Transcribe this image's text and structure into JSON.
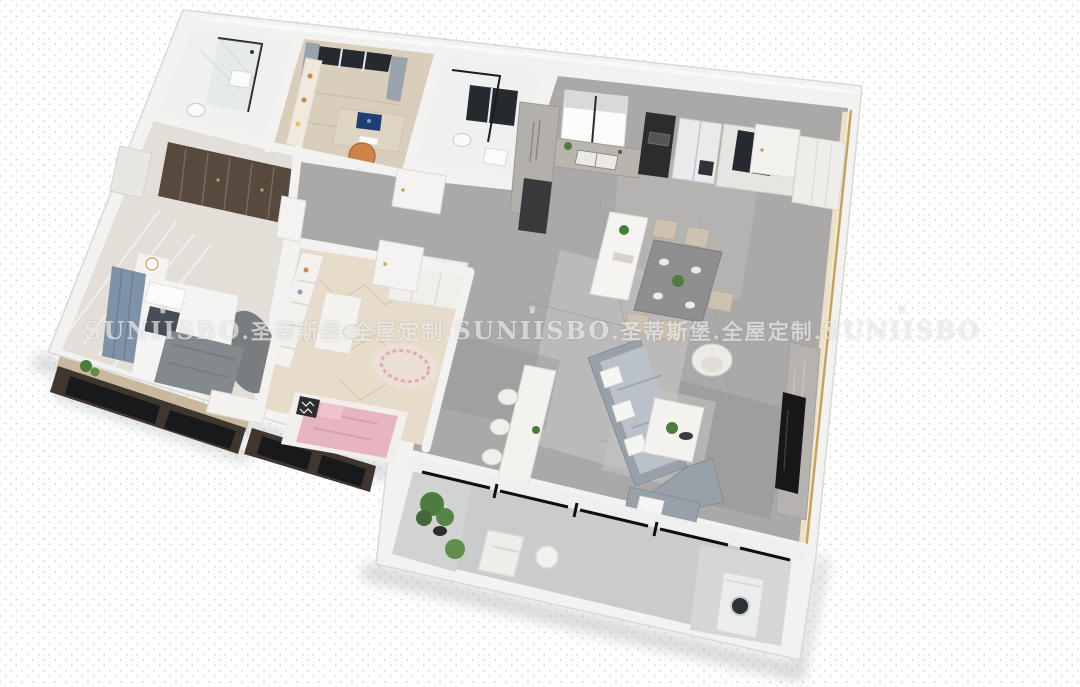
{
  "meta": {
    "type": "3d-apartment-floorplan-render",
    "brand": "SUNIISBO",
    "brand_cn": "圣蒂斯堡",
    "tagline_cn": "全屋定制"
  },
  "watermark": {
    "segments": [
      "SUNIISBO",
      ".圣蒂斯堡.全屋定制.",
      "SUNIISBO",
      ".圣蒂斯堡.全屋定制.",
      "SUNIISBO"
    ],
    "crown_glyph": "♛"
  },
  "palette": {
    "bg": "#ffffff",
    "dot": "#e6e2de",
    "wall": "#f2f2f0",
    "wall_edge": "#d8d8d6",
    "marble": "#aba9a8",
    "marble_light": "#c9c7c6",
    "marble_dark": "#92908f",
    "wood": "#d9cdbb",
    "herring": "#e7dbc9",
    "concrete": "#c9cccb",
    "gold": "#c6a35c",
    "glow": "#f6ead0",
    "sofa": "#98a1aa",
    "sofa_light": "#bac1c8",
    "white_furn": "#f3f2ef",
    "beige": "#cdc2b1",
    "pink": "#e7b4c1",
    "headboard": "#7e92a8",
    "darkwood": "#57493d",
    "orange": "#cc8448",
    "green": "#4e7c3f",
    "dark_glass": "#26292d",
    "fridge": "#e9eaec",
    "tv": "#17171a",
    "shadow": "#aab0b3",
    "bath": "#eff1f1",
    "blanket": "#84898d",
    "watermark": "rgba(252,250,247,0.62)"
  },
  "scene": {
    "view": "isometric-top-down-cutaway",
    "rooms": [
      {
        "name": "living-room",
        "floor": "gray-marble",
        "items": [
          "l-shaped-sofa",
          "loveseat",
          "coffee-table",
          "armchair",
          "console-table-with-chairs",
          "tv-wall",
          "tv"
        ]
      },
      {
        "name": "dining-area",
        "floor": "gray-marble",
        "items": [
          "dining-table",
          "dining-chairs",
          "kitchen-island",
          "plant"
        ]
      },
      {
        "name": "kitchen",
        "floor": "gray-marble",
        "items": [
          "window-with-shade",
          "double-sink",
          "counter",
          "oven-tower",
          "fridge",
          "glass-cabinet",
          "pantry-cabinets"
        ]
      },
      {
        "name": "entry-hall",
        "floor": "gray-marble",
        "items": [
          "shoe-cabinet",
          "entry-door",
          "wardrobe"
        ]
      },
      {
        "name": "hallway",
        "floor": "gray-marble",
        "items": [
          "door",
          "door",
          "door"
        ]
      },
      {
        "name": "master-bedroom",
        "floor": "light-wood-planks",
        "items": [
          "tufted-headboard-bed",
          "gray-blanket",
          "bench",
          "nightstand",
          "lamp",
          "dark-glass-wardrobe",
          "shelf",
          "arch-rug",
          "bay-window"
        ]
      },
      {
        "name": "kids-bedroom",
        "floor": "herringbone-wood",
        "items": [
          "bed-pink-blanket",
          "zigzag-pillow",
          "bookshelf",
          "desk",
          "round-rug",
          "wardrobe",
          "bay-window"
        ]
      },
      {
        "name": "study",
        "floor": "wood",
        "items": [
          "desk",
          "monitor",
          "orange-chair",
          "bookshelf",
          "window",
          "curtains"
        ]
      },
      {
        "name": "bathroom",
        "floor": "white-marble",
        "items": [
          "glass-shower",
          "toilet",
          "vanity"
        ]
      },
      {
        "name": "shower-room",
        "floor": "white-marble",
        "items": [
          "glass-shower",
          "window",
          "toilet"
        ]
      },
      {
        "name": "balcony",
        "floor": "concrete",
        "items": [
          "plants",
          "planter-pot",
          "lounge-chair",
          "side-table",
          "washing-machine",
          "sliding-glass-doors"
        ]
      }
    ]
  }
}
